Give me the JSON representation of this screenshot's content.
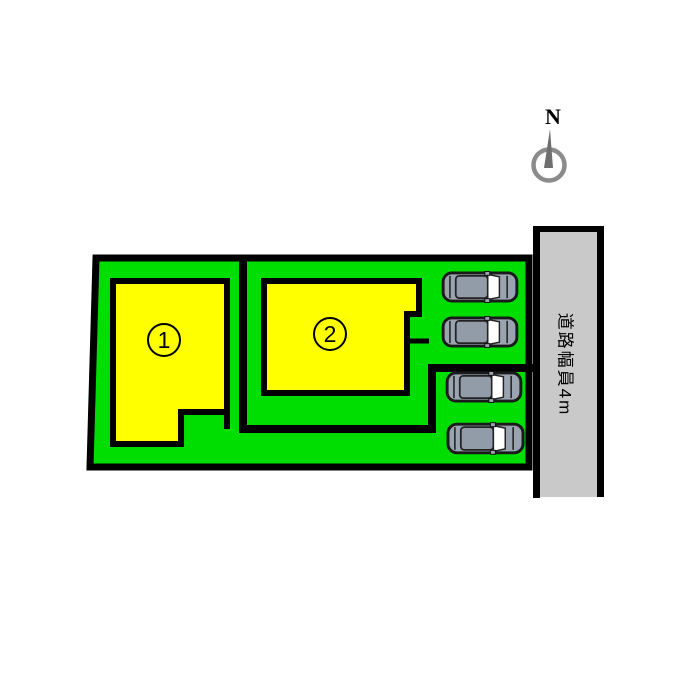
{
  "diagram": {
    "type": "real-estate-site-plan",
    "compass": {
      "label": "N"
    },
    "road": {
      "label": "道路幅員4m"
    },
    "lots": [
      {
        "number": "1"
      },
      {
        "number": "2"
      }
    ],
    "cars_count": 4,
    "colors": {
      "land_green": "#00dd00",
      "building_yellow": "#ffff00",
      "road_gray": "#c9c9c9",
      "outline_black": "#000000",
      "car_body_gray": "#9aa4b0",
      "car_roof_gray": "#929ca9",
      "windshield_white": "#ffffff",
      "compass_gray": "#8b8b8b"
    }
  }
}
